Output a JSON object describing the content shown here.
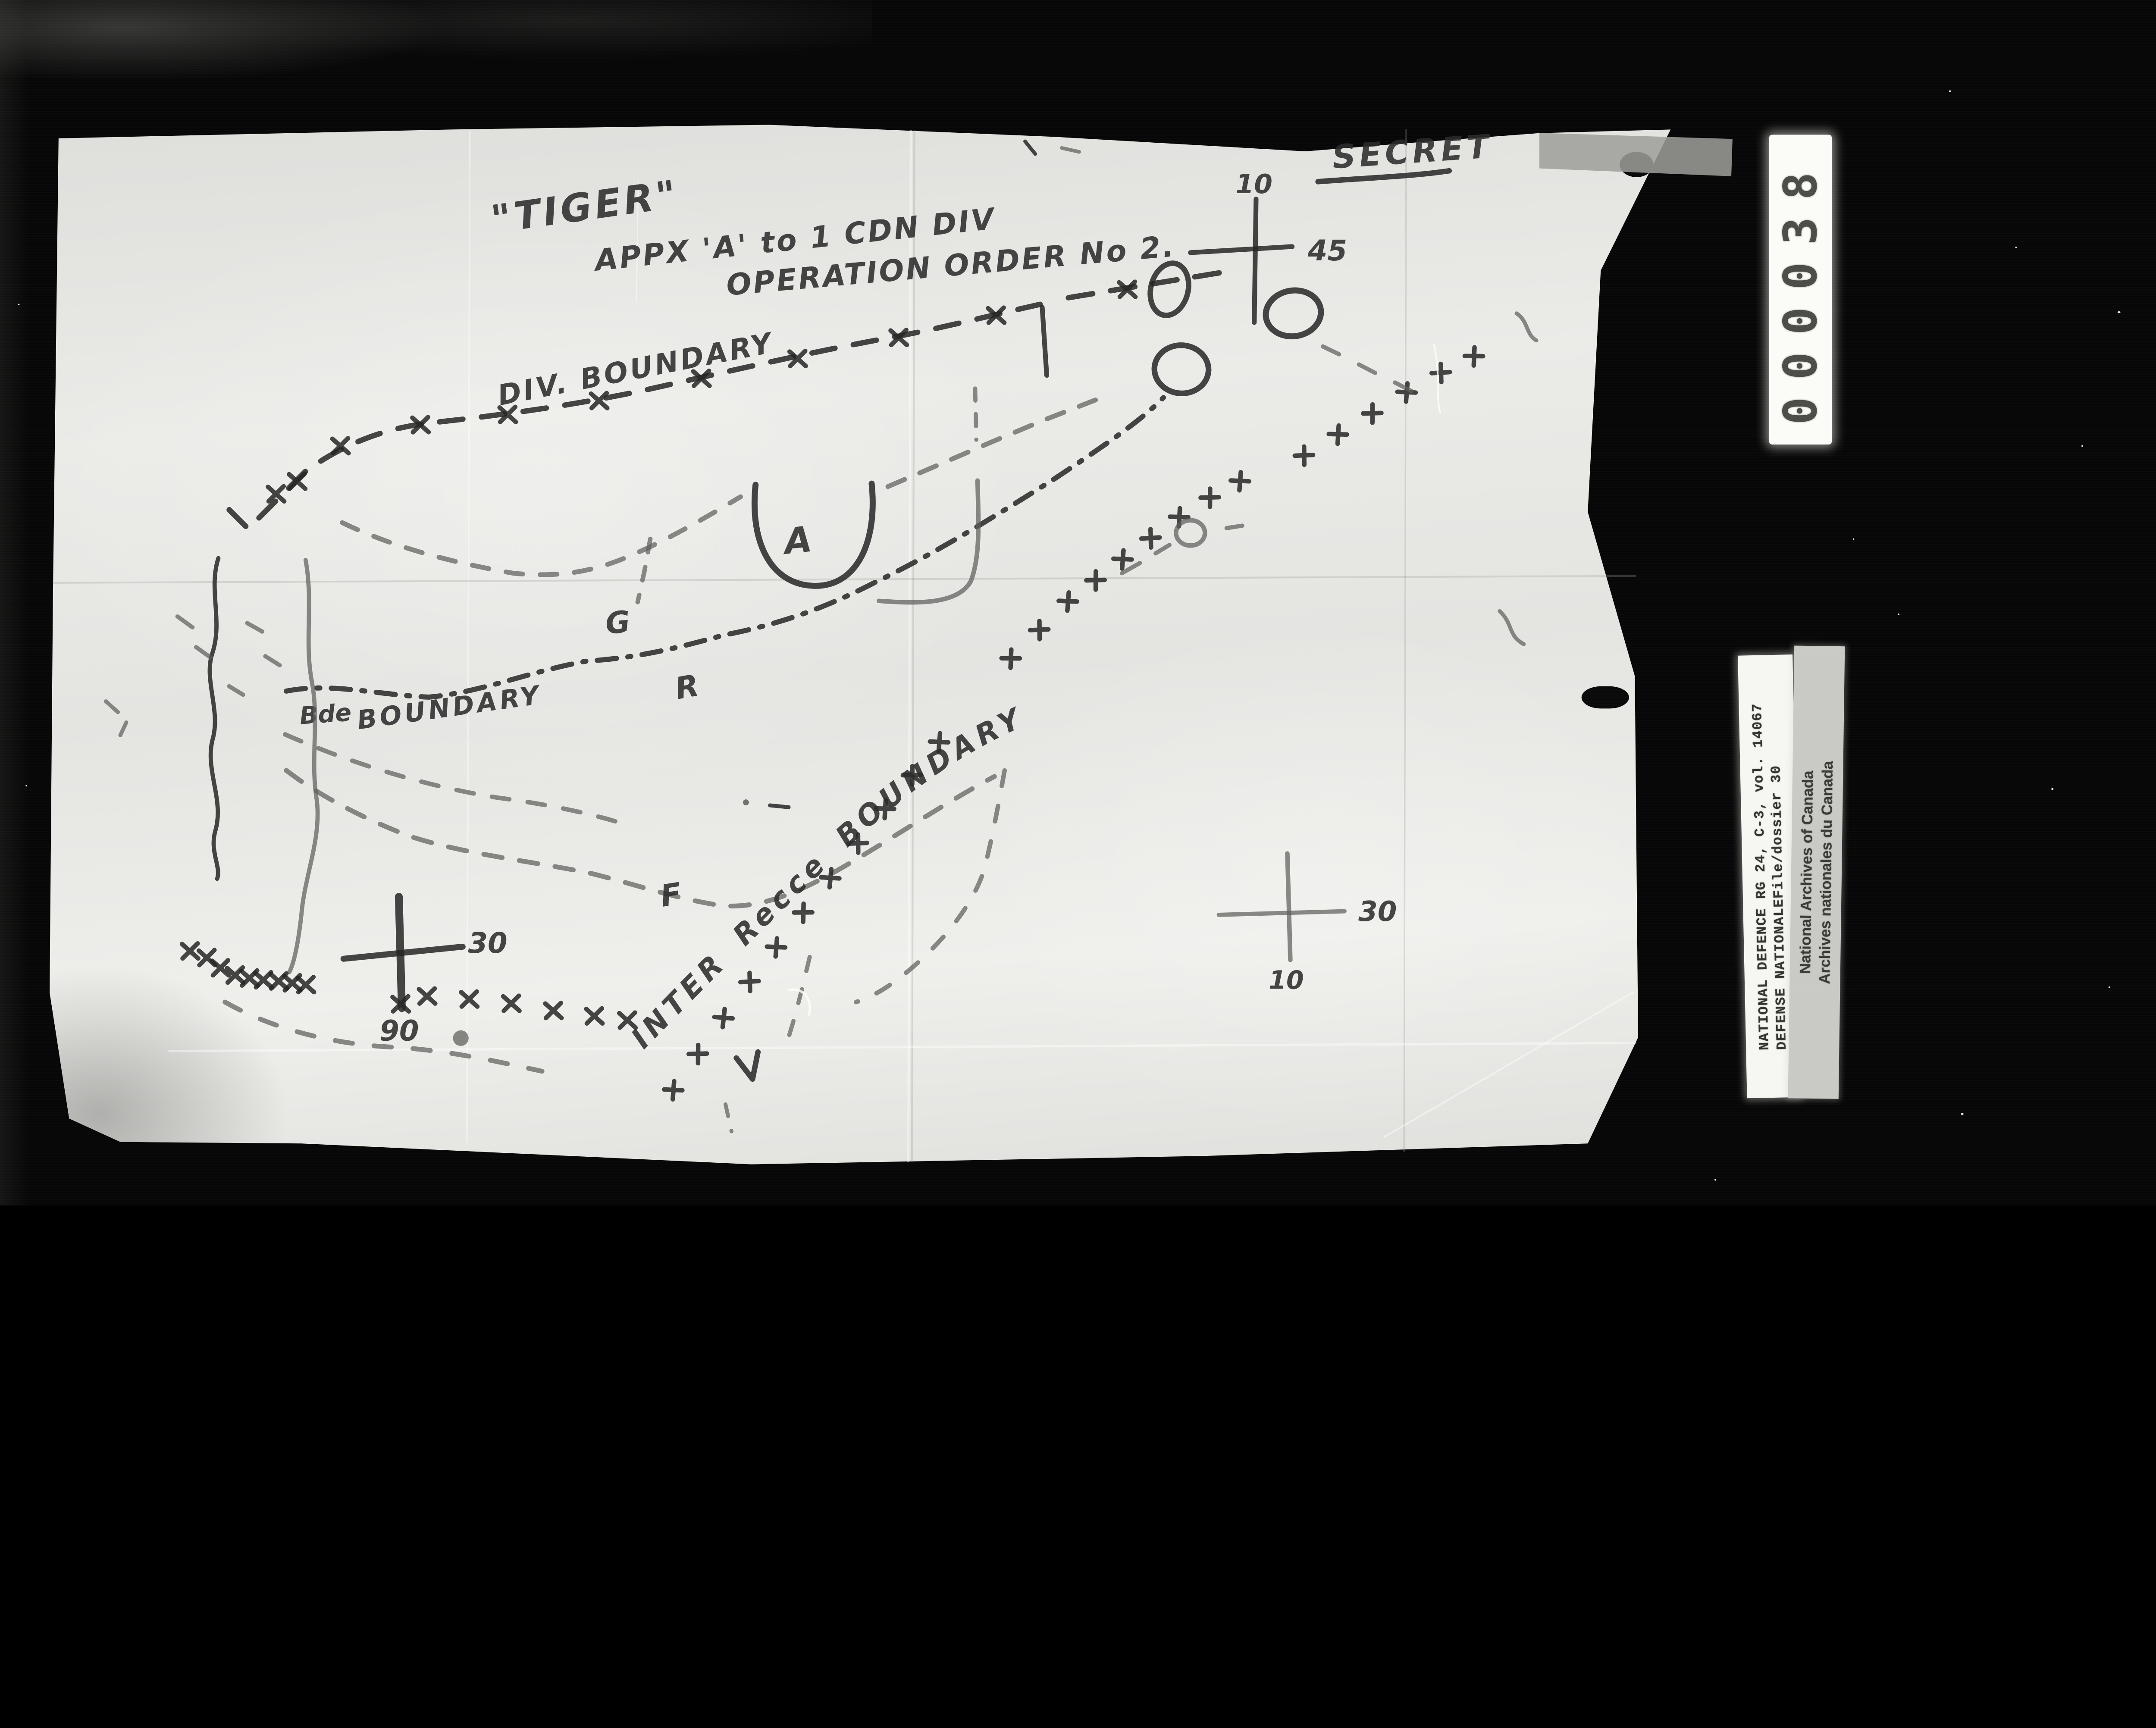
{
  "film": {
    "counter_value": "000038",
    "reference_card": {
      "ref_line1": "RG 24, C-3, vol. 14067",
      "ref_line2": "File/dossier 30",
      "dept_line1": "NATIONAL DEFENCE",
      "dept_line2": "DEFENSE NATIONALE"
    },
    "archive_card": {
      "line1": "National Archives of Canada",
      "line2": "Archives nationales du Canada"
    }
  },
  "map": {
    "classification": "SECRET",
    "title": {
      "line1": "\"TIGER\"",
      "line2": "APPX 'A' to 1 CDN DIV",
      "line3": "OPERATION ORDER No 2."
    },
    "labels": {
      "div_boundary": "DIV. BOUNDARY",
      "bde": "Bde",
      "bde_boundary_word": "BOUNDARY",
      "recce_boundary": "INTER  Recce  BOUNDARY"
    },
    "letters": {
      "a": "A",
      "g": "G",
      "r": "R",
      "f": "F"
    },
    "grid": {
      "top_cross": {
        "north": "10",
        "east": "45"
      },
      "left_cross": {
        "east": "30",
        "south": "90"
      },
      "right_cross": {
        "east": "30",
        "south": "10"
      }
    },
    "colors": {
      "film_black": "#070707",
      "paper": "#e8e8e5",
      "ink": "#242424",
      "pencil": "#5d5d5a"
    }
  }
}
